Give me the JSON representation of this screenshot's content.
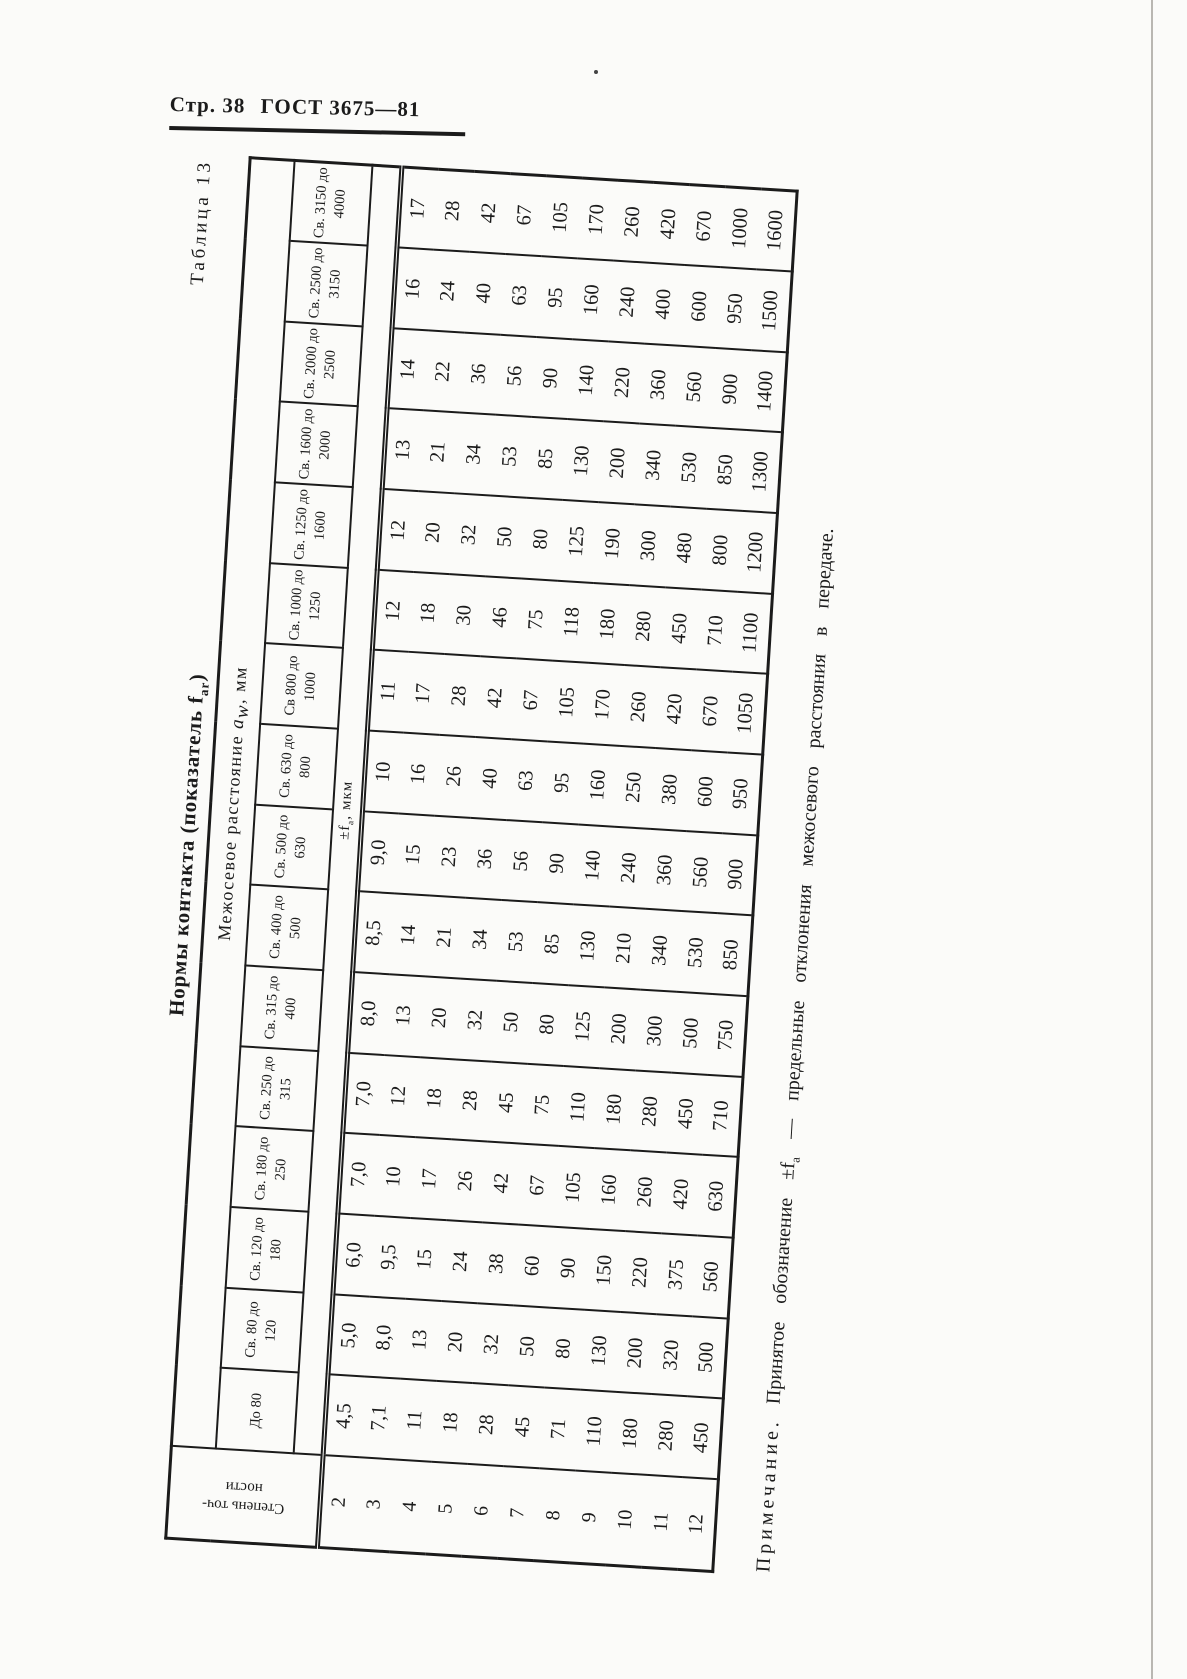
{
  "page": {
    "header_left": "Стр. 38",
    "header_right": "ГОСТ 3675—81"
  },
  "table": {
    "caption": "Таблица 13",
    "title": {
      "main": "Нормы контакта (показатель f",
      "sub": "ar",
      "close": ")"
    },
    "group_header": {
      "pre": "Межосевое расстояние ",
      "var": "a",
      "var_sub": "w",
      "post": ", мм"
    },
    "stub_header": {
      "line1": "Степень точ-",
      "line2": "ности"
    },
    "unit": {
      "pre": "±f",
      "sub": "a",
      "post": ", мкм"
    },
    "columns": [
      "До 80",
      "Св. 80 до 120",
      "Св. 120 до 180",
      "Св. 180 до 250",
      "Св. 250 до 315",
      "Св. 315 до 400",
      "Св. 400 до 500",
      "Св. 500 до 630",
      "Св. 630 до 800",
      "Св 800 до 1000",
      "Св. 1000 до 1250",
      "Св. 1250 до 1600",
      "Св. 1600 до 2000",
      "Св. 2000 до 2500",
      "Св. 2500 до 3150",
      "Св. 3150 до 4000"
    ],
    "rows": [
      {
        "degree": "2",
        "values": [
          "4,5",
          "5,0",
          "6,0",
          "7,0",
          "7,0",
          "8,0",
          "8,5",
          "9,0",
          "10",
          "11",
          "12",
          "12",
          "13",
          "14",
          "16",
          "17"
        ]
      },
      {
        "degree": "3",
        "values": [
          "7,1",
          "8,0",
          "9,5",
          "10",
          "12",
          "13",
          "14",
          "15",
          "16",
          "17",
          "18",
          "20",
          "21",
          "22",
          "24",
          "28"
        ]
      },
      {
        "degree": "4",
        "values": [
          "11",
          "13",
          "15",
          "17",
          "18",
          "20",
          "21",
          "23",
          "26",
          "28",
          "30",
          "32",
          "34",
          "36",
          "40",
          "42"
        ]
      },
      {
        "degree": "5",
        "values": [
          "18",
          "20",
          "24",
          "26",
          "28",
          "32",
          "34",
          "36",
          "40",
          "42",
          "46",
          "50",
          "53",
          "56",
          "63",
          "67"
        ]
      },
      {
        "degree": "6",
        "values": [
          "28",
          "32",
          "38",
          "42",
          "45",
          "50",
          "53",
          "56",
          "63",
          "67",
          "75",
          "80",
          "85",
          "90",
          "95",
          "105"
        ]
      },
      {
        "degree": "7",
        "values": [
          "45",
          "50",
          "60",
          "67",
          "75",
          "80",
          "85",
          "90",
          "95",
          "105",
          "118",
          "125",
          "130",
          "140",
          "160",
          "170"
        ]
      },
      {
        "degree": "8",
        "values": [
          "71",
          "80",
          "90",
          "105",
          "110",
          "125",
          "130",
          "140",
          "160",
          "170",
          "180",
          "190",
          "200",
          "220",
          "240",
          "260"
        ]
      },
      {
        "degree": "9",
        "values": [
          "110",
          "130",
          "150",
          "160",
          "180",
          "200",
          "210",
          "240",
          "250",
          "260",
          "280",
          "300",
          "340",
          "360",
          "400",
          "420"
        ]
      },
      {
        "degree": "10",
        "values": [
          "180",
          "200",
          "220",
          "260",
          "280",
          "300",
          "340",
          "360",
          "380",
          "420",
          "450",
          "480",
          "530",
          "560",
          "600",
          "670"
        ]
      },
      {
        "degree": "11",
        "values": [
          "280",
          "320",
          "375",
          "420",
          "450",
          "500",
          "530",
          "560",
          "600",
          "670",
          "710",
          "800",
          "850",
          "900",
          "950",
          "1000"
        ]
      },
      {
        "degree": "12",
        "values": [
          "450",
          "500",
          "560",
          "630",
          "710",
          "750",
          "850",
          "900",
          "950",
          "1050",
          "1100",
          "1200",
          "1300",
          "1400",
          "1500",
          "1600"
        ]
      }
    ]
  },
  "note": {
    "label": "Примечание.",
    "pre": "Принятое обозначение ±f",
    "sub": "a",
    "post": " — предельные отклонения межосевого расстояния в передаче."
  }
}
